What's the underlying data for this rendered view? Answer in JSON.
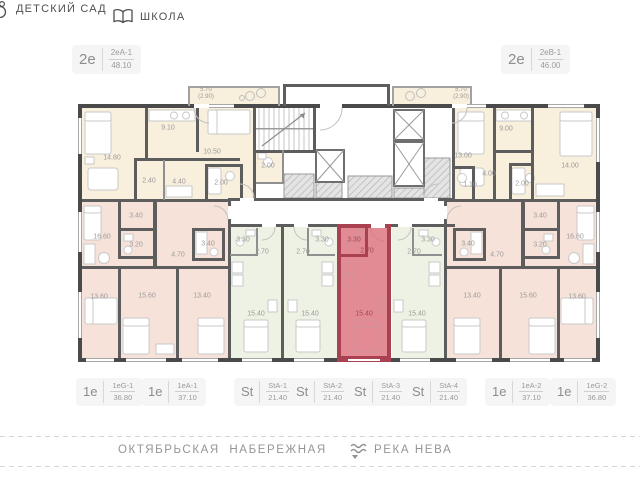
{
  "header": {
    "kindergarten_label": "ДЕТСКИЙ САД",
    "school_label": "ШКОЛА"
  },
  "top_units": [
    {
      "type": "2е",
      "code": "2еА-1",
      "area": "48.10"
    },
    {
      "type": "2е",
      "code": "2еВ-1",
      "area": "46.00"
    }
  ],
  "bottom_units": [
    {
      "type": "1е",
      "code": "1еG-1",
      "area": "36.80"
    },
    {
      "type": "1е",
      "code": "1еА-1",
      "area": "37.10"
    },
    {
      "type": "St",
      "code": "StA-1",
      "area": "21.40"
    },
    {
      "type": "St",
      "code": "StA-2",
      "area": "21.40"
    },
    {
      "type": "St",
      "code": "StA-3",
      "area": "21.40"
    },
    {
      "type": "St",
      "code": "StA-4",
      "area": "21.40"
    },
    {
      "type": "1е",
      "code": "1еА-2",
      "area": "37.10"
    },
    {
      "type": "1е",
      "code": "1еG-2",
      "area": "36.80"
    }
  ],
  "selected_unit": "StA-3",
  "plan": {
    "room_labels": [
      {
        "t": "14.80",
        "x": 112,
        "y": 158
      },
      {
        "t": "9.10",
        "x": 168,
        "y": 128
      },
      {
        "t": "10.50",
        "x": 212,
        "y": 152
      },
      {
        "t": "2.40",
        "x": 149,
        "y": 181
      },
      {
        "t": "4.40",
        "x": 179,
        "y": 182
      },
      {
        "t": "2.00",
        "x": 221,
        "y": 183
      },
      {
        "t": "2.00",
        "x": 268,
        "y": 166
      },
      {
        "t": "13.00",
        "x": 463,
        "y": 156
      },
      {
        "t": "9.00",
        "x": 506,
        "y": 129
      },
      {
        "t": "14.00",
        "x": 570,
        "y": 166
      },
      {
        "t": "4.00",
        "x": 489,
        "y": 174
      },
      {
        "t": "1.10",
        "x": 470,
        "y": 185
      },
      {
        "t": "2.00",
        "x": 522,
        "y": 184
      },
      {
        "t": "3.40",
        "x": 136,
        "y": 216
      },
      {
        "t": "16.60",
        "x": 102,
        "y": 237
      },
      {
        "t": "3.20",
        "x": 136,
        "y": 245
      },
      {
        "t": "4.70",
        "x": 178,
        "y": 255
      },
      {
        "t": "3.40",
        "x": 208,
        "y": 244
      },
      {
        "t": "13.60",
        "x": 99,
        "y": 297
      },
      {
        "t": "15.60",
        "x": 147,
        "y": 296
      },
      {
        "t": "13.40",
        "x": 202,
        "y": 296
      },
      {
        "t": "3.40",
        "x": 540,
        "y": 216
      },
      {
        "t": "16.60",
        "x": 575,
        "y": 237
      },
      {
        "t": "3.20",
        "x": 540,
        "y": 245
      },
      {
        "t": "4.70",
        "x": 497,
        "y": 255
      },
      {
        "t": "3.40",
        "x": 468,
        "y": 244
      },
      {
        "t": "13.60",
        "x": 577,
        "y": 297
      },
      {
        "t": "15.60",
        "x": 528,
        "y": 296
      },
      {
        "t": "13.40",
        "x": 472,
        "y": 296
      },
      {
        "t": "3.30",
        "x": 243,
        "y": 240
      },
      {
        "t": "2.70",
        "x": 262,
        "y": 252
      },
      {
        "t": "15.40",
        "x": 256,
        "y": 314
      },
      {
        "t": "3.30",
        "x": 322,
        "y": 240
      },
      {
        "t": "2.70",
        "x": 303,
        "y": 252
      },
      {
        "t": "15.40",
        "x": 310,
        "y": 314
      },
      {
        "t": "3.30",
        "x": 354,
        "y": 240,
        "red": true
      },
      {
        "t": "2.70",
        "x": 367,
        "y": 251,
        "red": true
      },
      {
        "t": "15.40",
        "x": 364,
        "y": 314,
        "red": true
      },
      {
        "t": "3.30",
        "x": 428,
        "y": 240
      },
      {
        "t": "2.70",
        "x": 414,
        "y": 252
      },
      {
        "t": "15.40",
        "x": 417,
        "y": 314
      }
    ],
    "balcony_labels": [
      {
        "t1": "5.70",
        "t2": "(2.90)",
        "x": 206,
        "y": 94
      },
      {
        "t1": "5.70",
        "t2": "(2.90)",
        "x": 461,
        "y": 94
      }
    ]
  },
  "footer": {
    "street": "ОКТЯБРЬСКАЯ  НАБЕРЕЖНАЯ",
    "river": "РЕКА НЕВА"
  },
  "colors": {
    "highlight": "#e38b95",
    "highlight_wall": "#aa4150",
    "highlight_text": "#9e4953",
    "cream": "#f8efdc",
    "pink": "#f6e2d9",
    "green": "#edf2e4",
    "wall": "#4a4a4a",
    "label_text": "#9b9b9b"
  }
}
